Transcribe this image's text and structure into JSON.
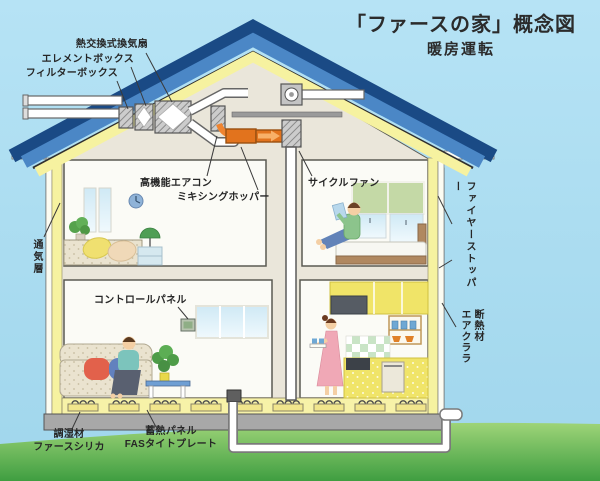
{
  "title": "「ファースの家」概念図",
  "subtitle": "暖房運転",
  "labels": {
    "heat_exchange_fan": "熱交換式換気扇",
    "element_box": "エレメントボックス",
    "filter_box": "フィルターボックス",
    "high_performance_aircon": "高機能エアコン",
    "mixing_hopper": "ミキシングホッパー",
    "cycle_fan": "サイクルファン",
    "fire_stopper": "ファイヤーストッパー",
    "ventilation_layer": "通気層",
    "control_panel": "コントロールパネル",
    "insulation_material": "断熱材",
    "insulation_product": "エアクララ",
    "humidity_material": "調湿材",
    "humidity_product": "ファースシリカ",
    "heat_storage_panel": "蓄熱パネル",
    "heat_storage_product": "FASタイトプレート"
  },
  "colors": {
    "sky": "#aadcf2",
    "grass": "#57a94a",
    "roof_outer": "#1a4a85",
    "roof_inner": "#4b87c6",
    "insulation_yellow": "#f6f2a0",
    "interior_cream": "#eae6da",
    "duct_orange": "#e2731d",
    "label_text": "#262626"
  }
}
